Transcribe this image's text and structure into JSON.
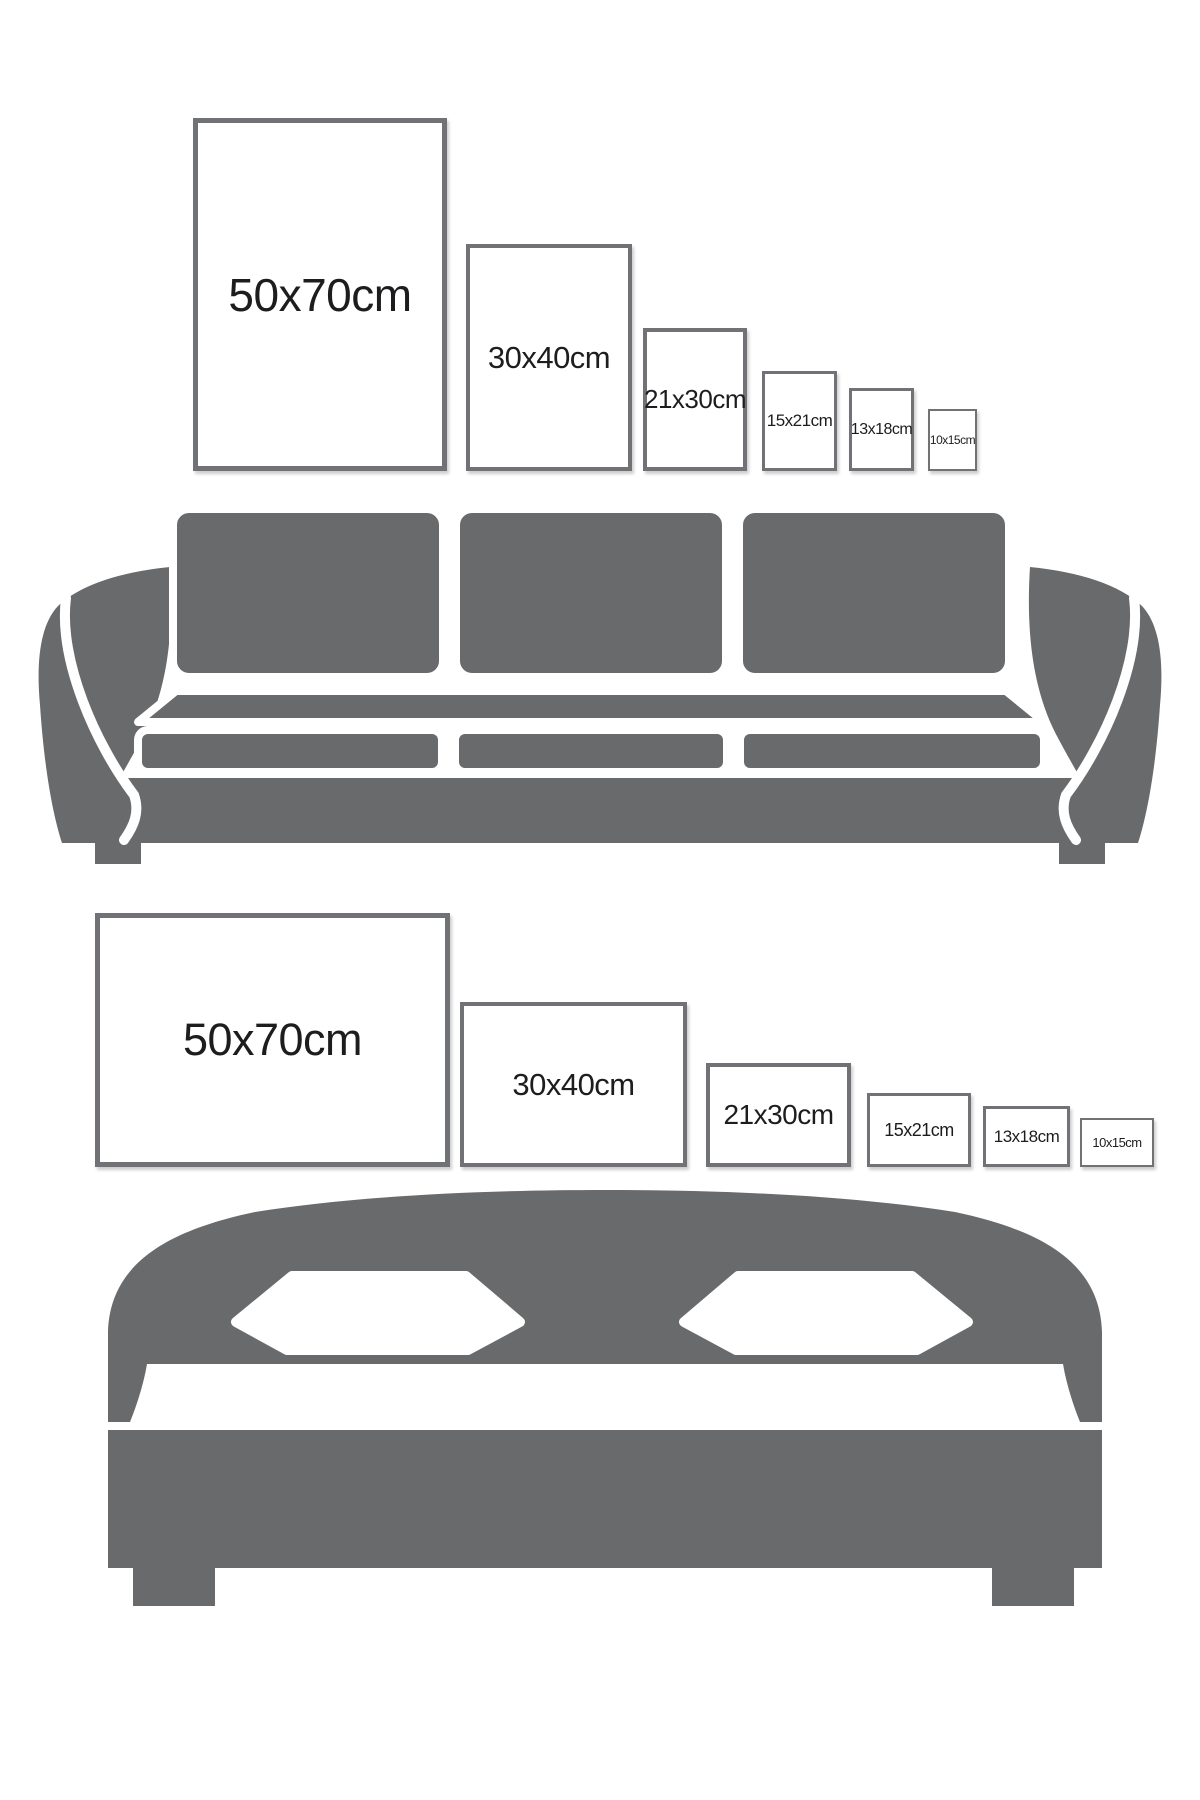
{
  "page": {
    "background": "#ffffff",
    "description": "Poster frame size comparison guide shown above a sofa and above a bed"
  },
  "colors": {
    "furniture_gray": "#696a6c",
    "frame_border": "#717275",
    "label_text": "#1d1d1f"
  },
  "sofa_section": {
    "illustration": "sofa",
    "frames": [
      {
        "label": "50x70cm",
        "orientation": "portrait"
      },
      {
        "label": "30x40cm",
        "orientation": "portrait"
      },
      {
        "label": "21x30cm",
        "orientation": "portrait"
      },
      {
        "label": "15x21cm",
        "orientation": "portrait"
      },
      {
        "label": "13x18cm",
        "orientation": "portrait"
      },
      {
        "label": "10x15cm",
        "orientation": "portrait"
      }
    ]
  },
  "bed_section": {
    "illustration": "bed",
    "frames": [
      {
        "label": "50x70cm",
        "orientation": "landscape"
      },
      {
        "label": "30x40cm",
        "orientation": "landscape"
      },
      {
        "label": "21x30cm",
        "orientation": "landscape"
      },
      {
        "label": "15x21cm",
        "orientation": "landscape"
      },
      {
        "label": "13x18cm",
        "orientation": "landscape"
      },
      {
        "label": "10x15cm",
        "orientation": "landscape"
      }
    ]
  }
}
